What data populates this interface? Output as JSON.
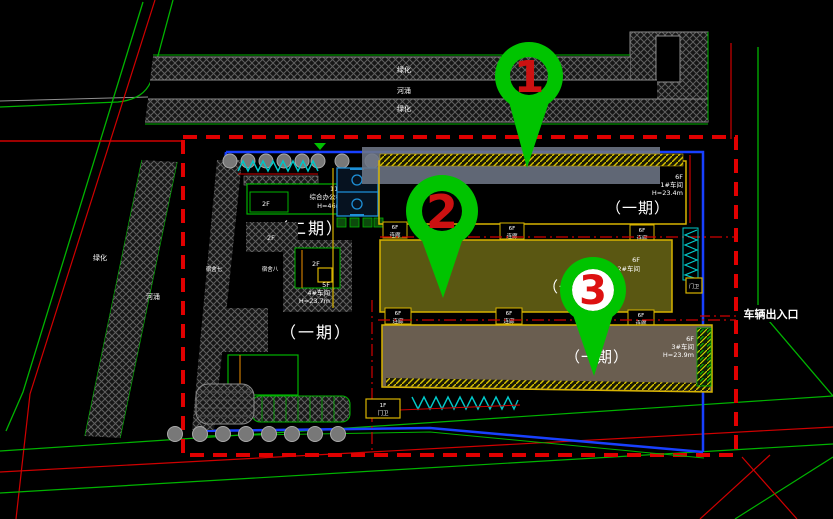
{
  "pins": [
    {
      "number": "1"
    },
    {
      "number": "2"
    },
    {
      "number": "3"
    }
  ],
  "site": {
    "top_strip": {
      "green_top": "绿化",
      "river": "河涌",
      "green_bottom": "绿化"
    },
    "left_strip": {
      "green": "绿化",
      "river": "河涌"
    },
    "entrance_label": "车辆出入口",
    "phase2_label": "（二期）"
  },
  "buildings": {
    "workshop1": {
      "floors": "6F",
      "name": "1#车间",
      "height": "H=23.4m",
      "phase": "（一期）"
    },
    "workshop2": {
      "floors": "6F",
      "name": "2#车间",
      "phase": "（一期）"
    },
    "workshop3": {
      "floors": "6F",
      "name": "3#车间",
      "height": "H=23.9m",
      "phase": "（一期）"
    },
    "workshop4": {
      "floors": "5F",
      "name": "4#车间",
      "height": "H=23.7m"
    },
    "office": {
      "floors": "11F",
      "name": "综合办公楼",
      "height": "H=46m"
    },
    "dorm_a": "宿舍七",
    "dorm_b": "宿舍八",
    "phase2_area_label": "（一期）"
  },
  "connectors": {
    "floors": "6F",
    "label": "连廊"
  },
  "gates": {
    "main_floors": "1F",
    "main": "门卫",
    "side": "门卫"
  },
  "misc": {
    "f2": "2F"
  },
  "colors": {
    "pin_green": "#00c400",
    "pin_number_red": "#cc1111",
    "boundary_red": "#e00000",
    "site_blue": "#1840ff",
    "building_outline_yellow": "#d8b400",
    "road_green": "#00b400",
    "road_red": "#d00000",
    "court_blue": "#1e90d8",
    "hatch_cyan": "#00c8c8"
  }
}
